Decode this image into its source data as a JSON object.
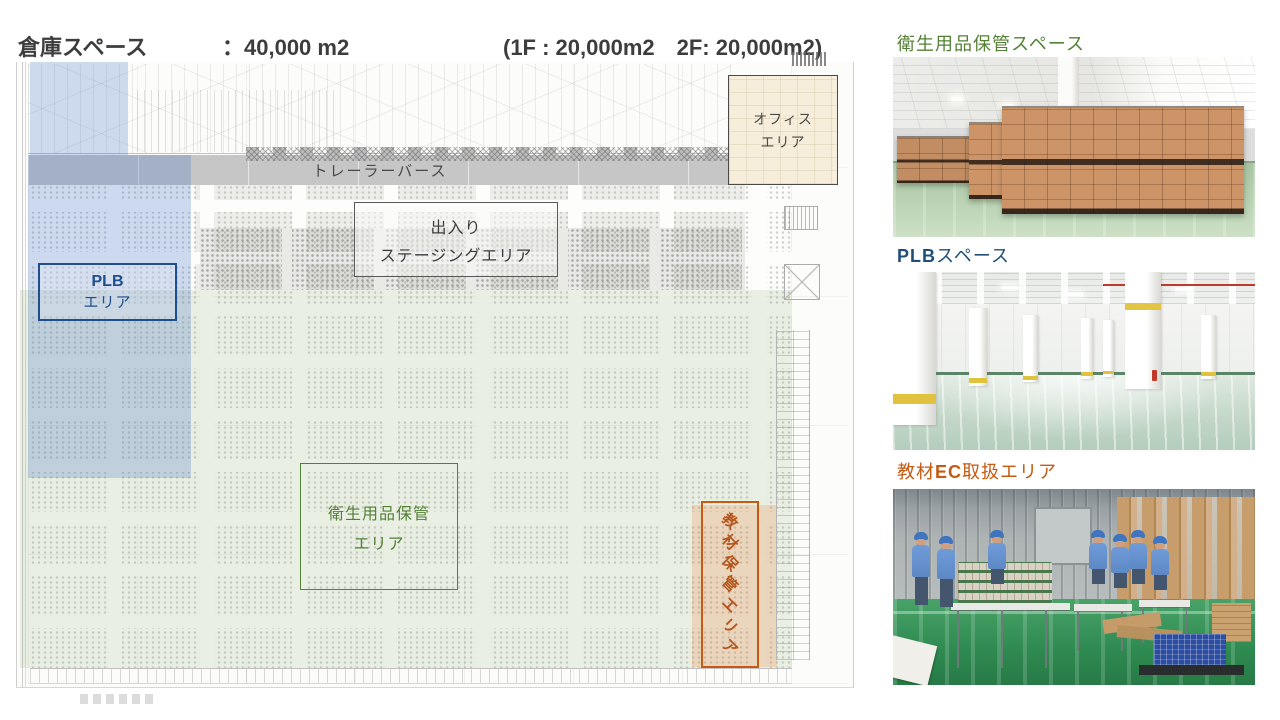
{
  "header": {
    "line1": {
      "label": "倉庫スペース",
      "value": "：40,000 m2",
      "note": "(1F : 20,000m2　2F: 20,000m2)"
    },
    "line2": {
      "label": "保税スペース",
      "value": "：倉庫内  3,000 m2",
      "note": "倉庫外  7,000m2"
    }
  },
  "floorplan": {
    "trailer_berth_label": "トレーラーバース",
    "staging_label_line1": "出入り",
    "staging_label_line2": "ステージングエリア",
    "office_label_line1": "オフィス",
    "office_label_line2": "エリア",
    "plb_label_line1": "PLB",
    "plb_label_line2": "エリア",
    "hygiene_label_line1": "衛生用品保管",
    "hygiene_label_line2": "エリア",
    "materials_label": "教材保管エリア",
    "colors": {
      "plb_accent": "#1f4e8c",
      "plb_zone_tint": "#ccd5ea",
      "hygiene_accent": "#538135",
      "hygiene_zone_tint": "#eef1ea",
      "materials_accent": "#c55a11",
      "materials_zone_tint": "#f7e0cf",
      "office_fill": "#f6eedb",
      "trailer_band_gray": "#c6c6c6"
    }
  },
  "photos": {
    "hygiene": {
      "caption": "衛生用品保管スペース",
      "caption_color": "#538135"
    },
    "plb": {
      "caption_strong": "PLB",
      "caption_rest": "スペース",
      "caption_color": "#1f4e79"
    },
    "materials": {
      "caption_pre": "教材",
      "caption_strong": "EC",
      "caption_rest": "取扱エリア",
      "caption_color": "#c55a11"
    }
  }
}
